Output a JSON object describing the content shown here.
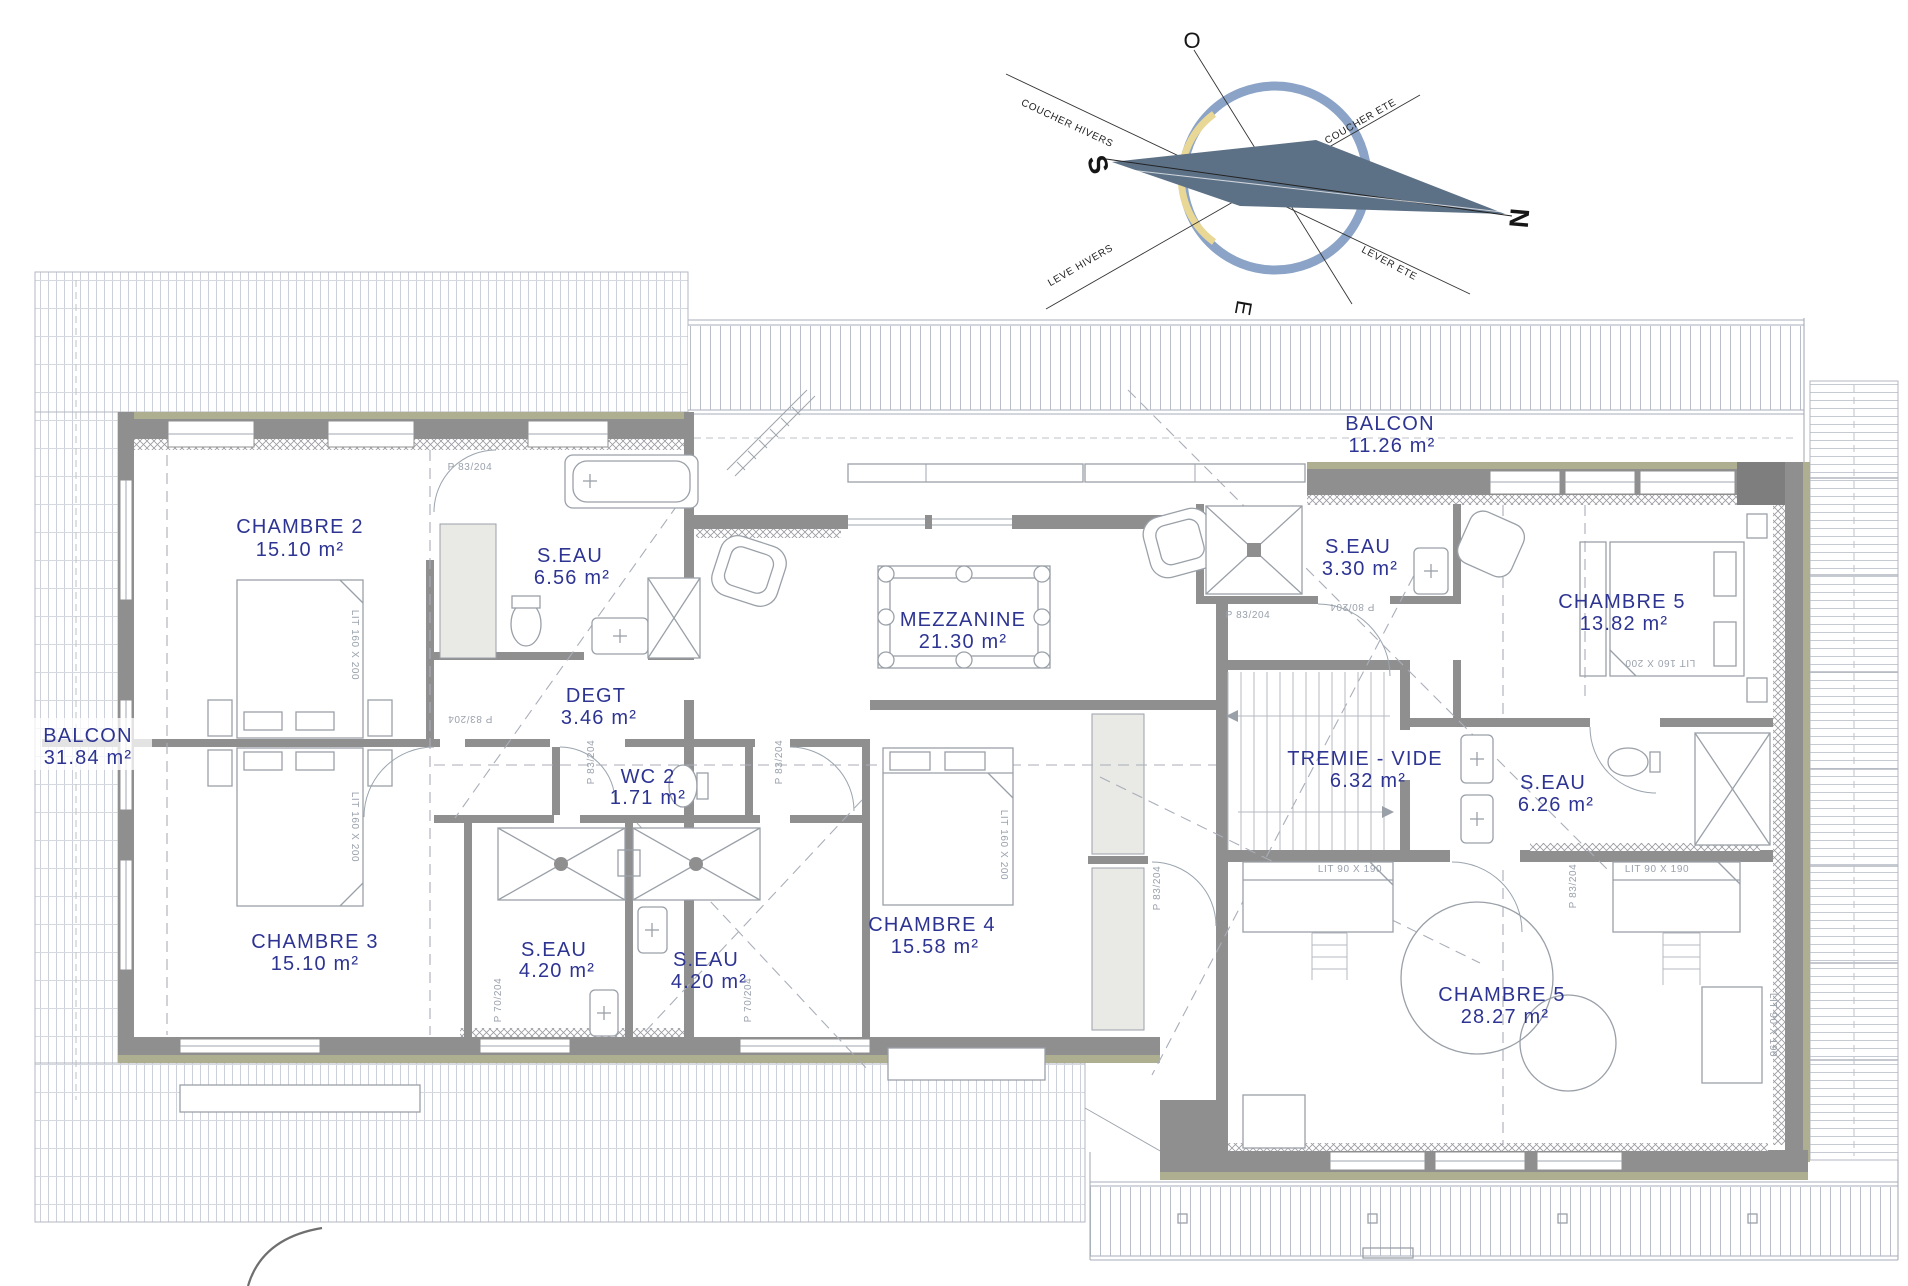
{
  "plan_title": "Floor plan – niveau étage (chambres)",
  "compass": {
    "north": "N",
    "south": "S",
    "east": "E",
    "west": "O",
    "coucher_hivers": "COUCHER HIVERS",
    "coucher_ete": "COUCHER ETE",
    "leve_hivers": "LEVE HIVERS",
    "lever_ete": "LEVER ETE"
  },
  "rooms": {
    "balcon_ouest": {
      "name": "BALCON",
      "area": "31.84 m²"
    },
    "chambre2": {
      "name": "CHAMBRE 2",
      "area": "15.10 m²"
    },
    "seau_656": {
      "name": "S.EAU",
      "area": "6.56 m²"
    },
    "degt": {
      "name": "DEGT",
      "area": "3.46 m²"
    },
    "wc2": {
      "name": "WC 2",
      "area": "1.71 m²"
    },
    "chambre3": {
      "name": "CHAMBRE 3",
      "area": "15.10 m²"
    },
    "seau_420_g": {
      "name": "S.EAU",
      "area": "4.20 m²"
    },
    "seau_420_d": {
      "name": "S.EAU",
      "area": "4.20 m²"
    },
    "chambre4": {
      "name": "CHAMBRE 4",
      "area": "15.58 m²"
    },
    "mezzanine": {
      "name": "MEZZANINE",
      "area": "21.30 m²"
    },
    "balcon_nord": {
      "name": "BALCON",
      "area": "11.26 m²"
    },
    "seau_330": {
      "name": "S.EAU",
      "area": "3.30 m²"
    },
    "chambre5_haut": {
      "name": "CHAMBRE 5",
      "area": "13.82 m²"
    },
    "tremie": {
      "name": "TREMIE - VIDE",
      "area": "6.32 m²"
    },
    "seau_626": {
      "name": "S.EAU",
      "area": "6.26 m²"
    },
    "chambre5_bas": {
      "name": "CHAMBRE 5",
      "area": "28.27 m²"
    }
  },
  "annotations": {
    "door_p83": "P 83/204",
    "door_p80": "P 80/204",
    "door_p70": "P 70/204",
    "lit_160": "LIT 160 X 200",
    "lit_90": "LIT 90 X 190"
  },
  "colors": {
    "label_blue": "#2e3492",
    "wall_gray": "#8f8f8f",
    "cladding_olive": "#aeae91",
    "compass_ring": "#8aa3c6",
    "compass_needle": "#5d7186",
    "sun_arc": "#e8d795",
    "deck_line": "#c9cdd5"
  }
}
